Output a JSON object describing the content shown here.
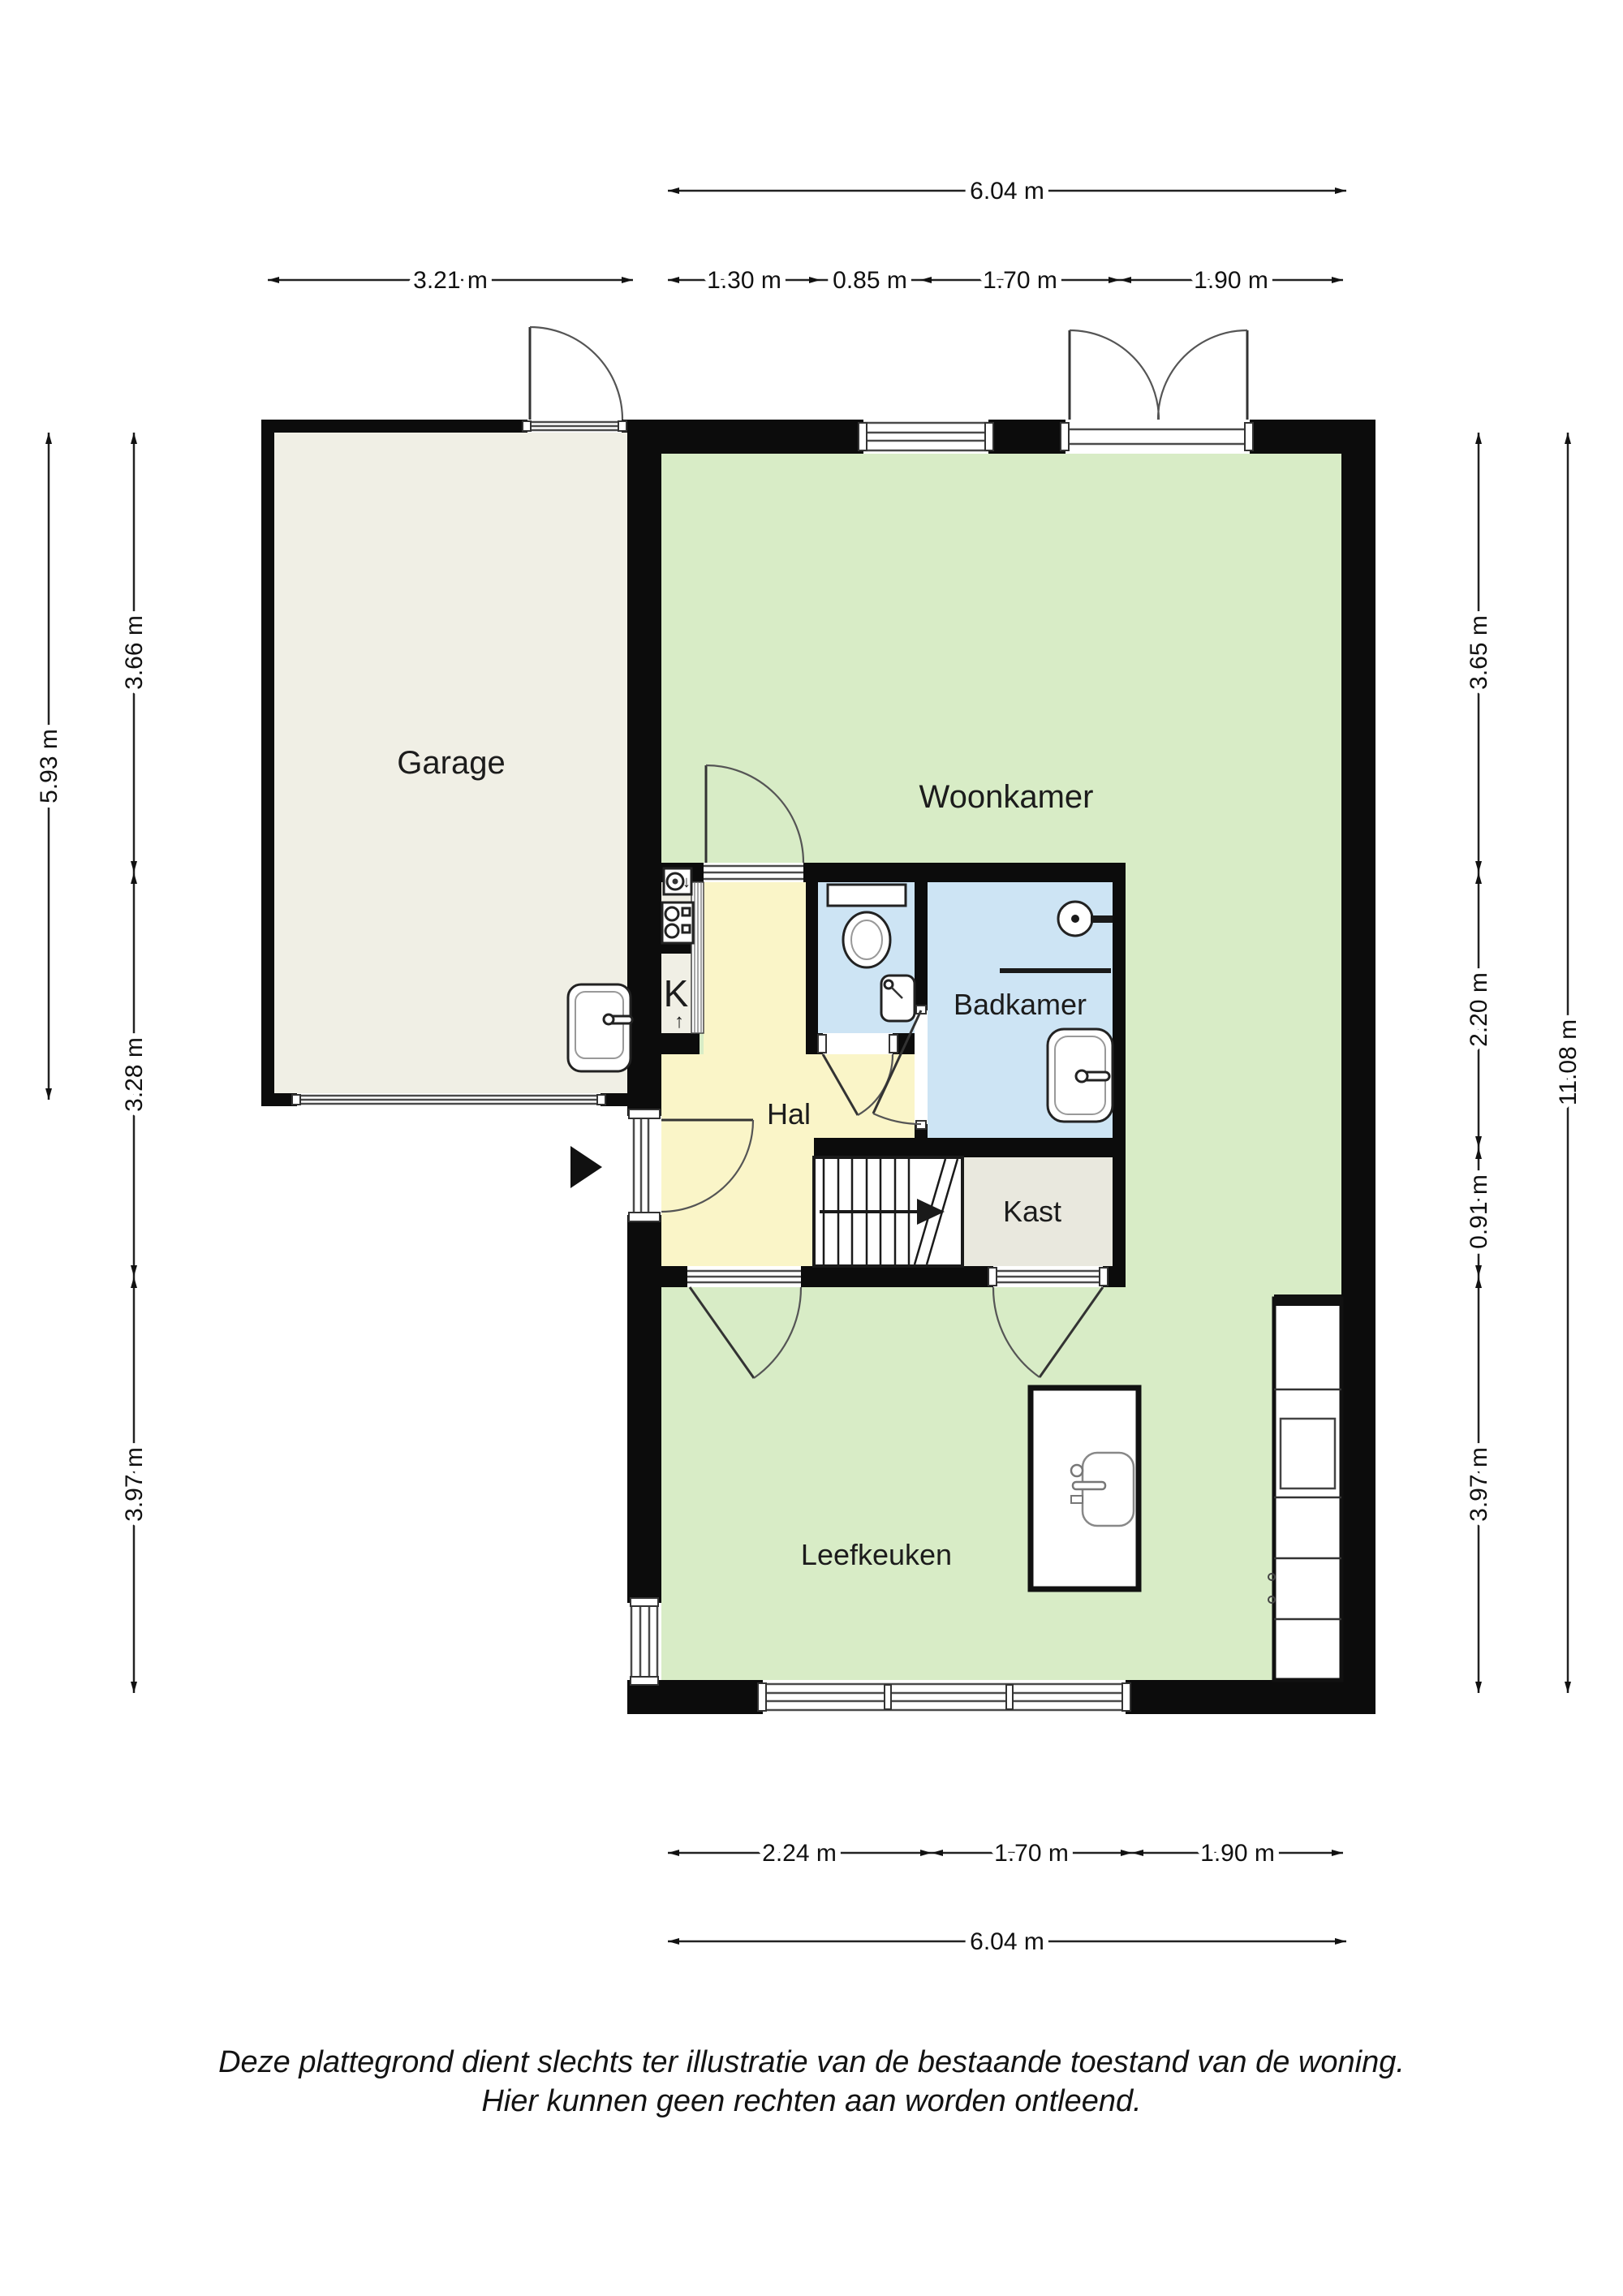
{
  "rooms": {
    "garage": "Garage",
    "woonkamer": "Woonkamer",
    "badkamer": "Badkamer",
    "hal": "Hal",
    "kast": "Kast",
    "leefkeuken": "Leefkeuken",
    "k": "K"
  },
  "annotations": {
    "k_arrow_up": "↑",
    "appliance_arrow_down": "↓"
  },
  "dims": {
    "top": {
      "total": "6.04 m",
      "garage": "3.21 m",
      "seg_1_30": "1.30 m",
      "seg_0_85": "0.85 m",
      "seg_1_70": "1.70 m",
      "seg_1_90": "1.90 m"
    },
    "bottom": {
      "seg_2_24": "2.24 m",
      "seg_1_70": "1.70 m",
      "seg_1_90": "1.90 m",
      "total": "6.04 m"
    },
    "left": {
      "outer": "5.93 m",
      "seg_3_66": "3.66 m",
      "seg_3_28": "3.28 m",
      "seg_3_97": "3.97 m"
    },
    "right": {
      "seg_3_65": "3.65 m",
      "seg_2_20": "2.20 m",
      "seg_0_91": "0.91 m",
      "seg_3_97": "3.97 m",
      "total": "11.08 m"
    }
  },
  "disclaimer": {
    "line1": "Deze plattegrond dient slechts ter illustratie van de bestaande toestand van de woning.",
    "line2": "Hier kunnen geen rechten aan worden ontleend."
  },
  "colors": {
    "wall": "#0c0c0c",
    "living": "#d8ecc6",
    "hall": "#faf5c8",
    "bath": "#cde4f4",
    "garage": "#f0efe5",
    "closet": "#e9e8de"
  }
}
